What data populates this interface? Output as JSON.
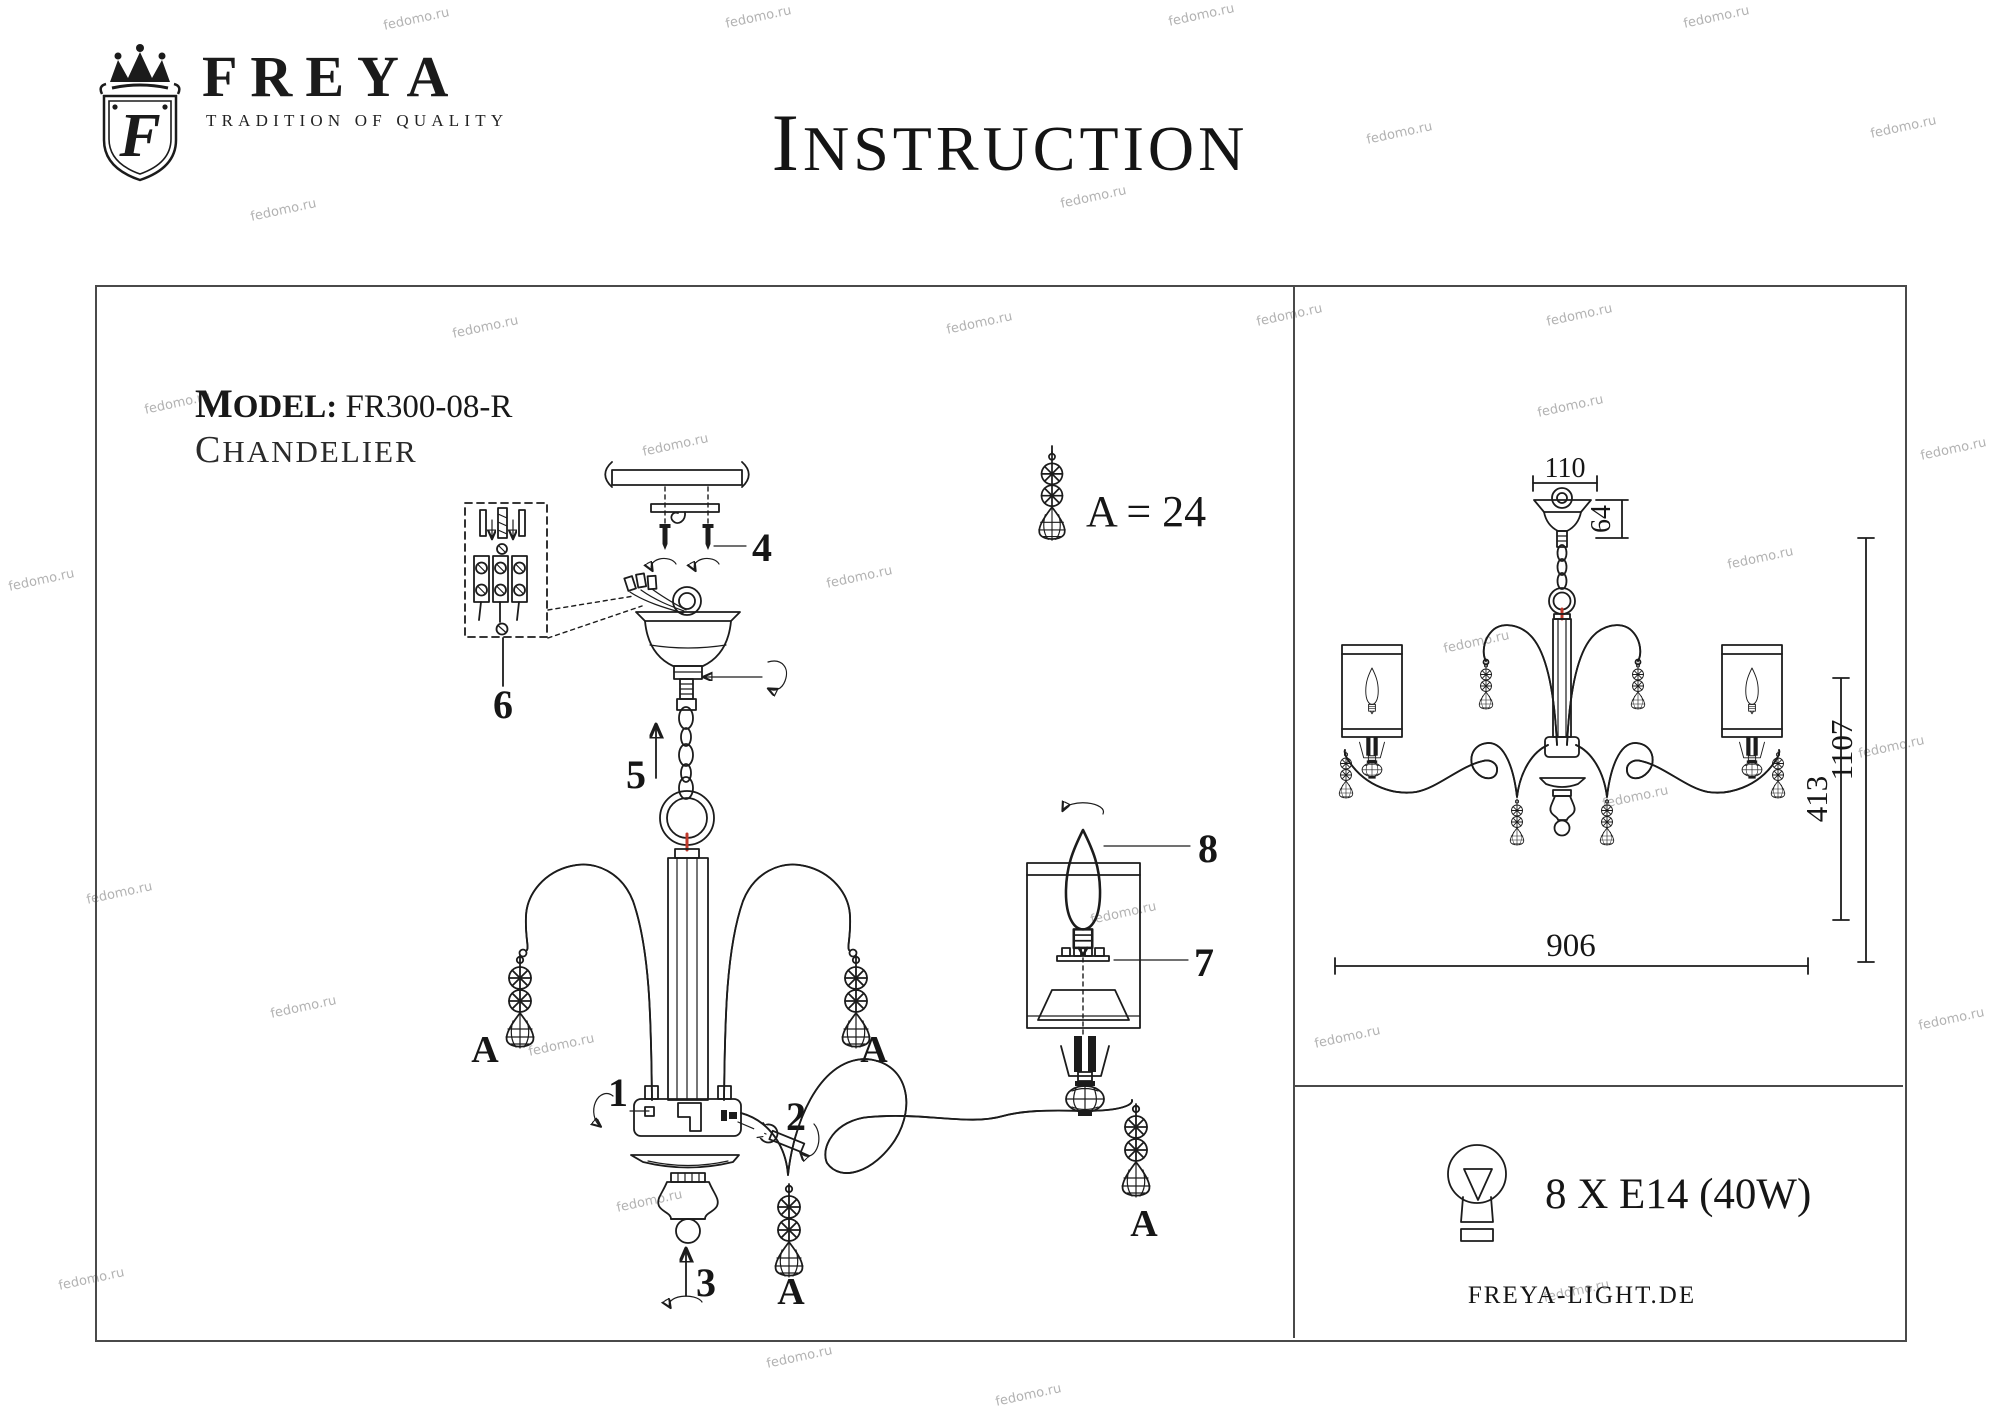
{
  "watermark": {
    "text": "fedomo.ru",
    "positions": [
      [
        383,
        12
      ],
      [
        725,
        10
      ],
      [
        1168,
        8
      ],
      [
        1683,
        10
      ],
      [
        250,
        203
      ],
      [
        1060,
        190
      ],
      [
        1366,
        126
      ],
      [
        1870,
        120
      ],
      [
        8,
        573
      ],
      [
        86,
        886
      ],
      [
        270,
        1000
      ],
      [
        58,
        1272
      ],
      [
        452,
        320
      ],
      [
        946,
        316
      ],
      [
        1256,
        308
      ],
      [
        1546,
        308
      ],
      [
        144,
        396
      ],
      [
        642,
        438
      ],
      [
        826,
        570
      ],
      [
        1537,
        399
      ],
      [
        1443,
        635
      ],
      [
        1727,
        551
      ],
      [
        1602,
        790
      ],
      [
        528,
        1038
      ],
      [
        616,
        1194
      ],
      [
        1090,
        906
      ],
      [
        1314,
        1030
      ],
      [
        1543,
        1284
      ],
      [
        1918,
        1012
      ],
      [
        766,
        1350
      ],
      [
        995,
        1388
      ],
      [
        1858,
        740
      ],
      [
        1920,
        442
      ]
    ]
  },
  "header": {
    "brand": "FREYA",
    "brand_initial": "F",
    "tagline": "TRADITION OF QUALITY",
    "title": "INSTRUCTION"
  },
  "left_panel": {
    "model_label": "MODEL:",
    "model_value": "FR300-08-R",
    "product_type": "CHANDELIER",
    "legend": "A = 24",
    "callouts": {
      "c1": "1",
      "c2": "2",
      "c3": "3",
      "c4": "4",
      "c5": "5",
      "c6": "6",
      "c7": "7",
      "c8": "8",
      "a": "A"
    }
  },
  "right_panel": {
    "dims": {
      "canopy_width": "110",
      "canopy_height": "64",
      "total_height": "1107",
      "body_height": "413",
      "body_width": "906"
    },
    "bulb_spec": "8 X E14 (40W)",
    "website": "FREYA-LIGHT.DE"
  },
  "colors": {
    "line": "#1c1c1c",
    "accent_red": "#c0392b",
    "watermark": "#9f9f9f",
    "border": "#4a4a4a"
  }
}
